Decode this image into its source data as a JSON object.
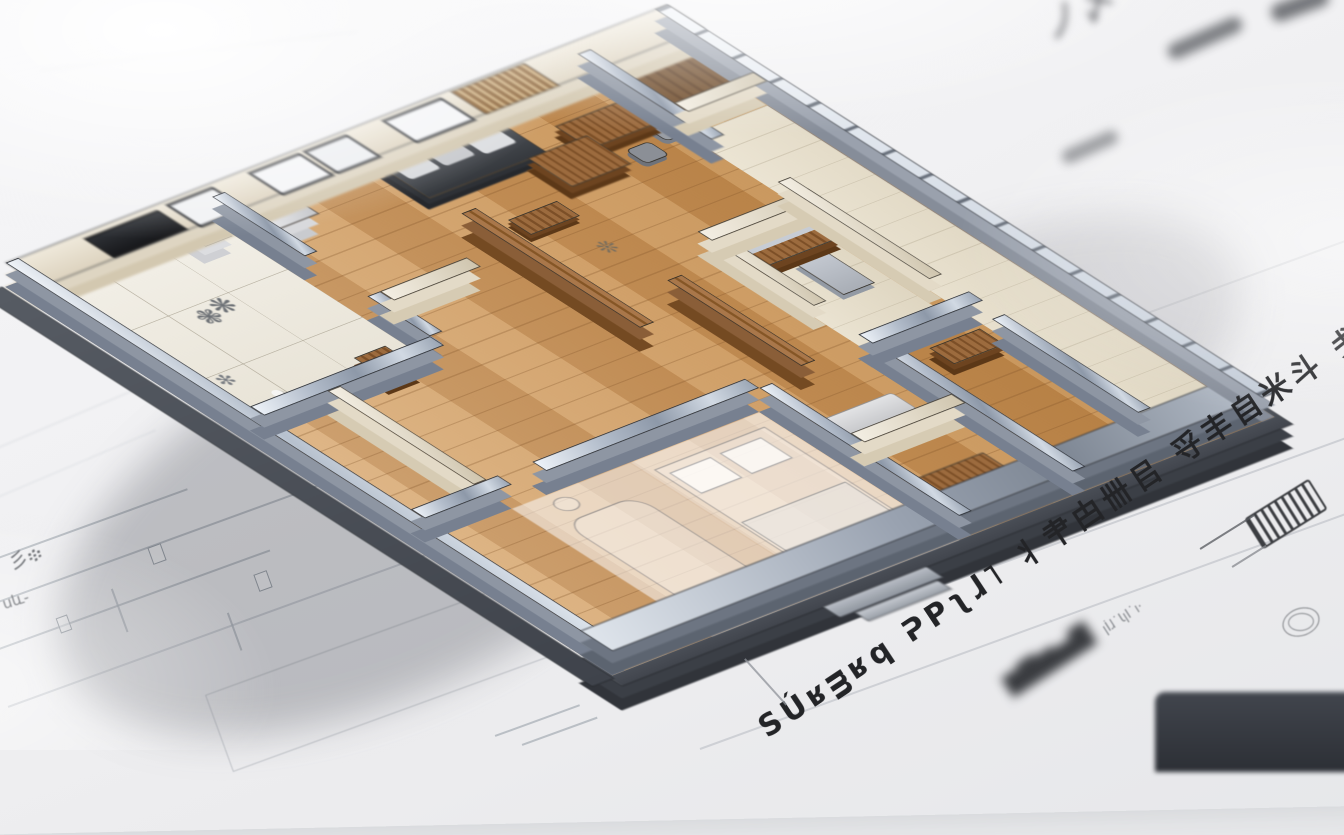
{
  "scene": {
    "description": "Photorealistic 3D architectural floor-plan model standing on blueprint sketch sheets",
    "annotations": {
      "handwritten_line": "SÚʁᴟʁq ᕈPʅɺ˥ 丬肀甴卌㠯 寽丰自米斗 戋≯",
      "handwritten_small": "ꞁİɺ˙ƖꞁI˙ı·",
      "smudged_text": "▆▇▆▅▇",
      "smudged_marks_top": "ノ〆ヽ",
      "pencil_scribble_left_a": "彡፨",
      "pencil_scribble_left_b": "սև֊",
      "plant_scribble_1": "❃❋",
      "plant_scribble_2": "✻",
      "wood_scribble": "❊"
    },
    "palette": {
      "paper": "#f2f2f4",
      "steel_wall": "#9aa5b4",
      "steel_dark": "#3f444c",
      "beige_wall": "#e9e2d2",
      "wood_floor": "#cf9f6b",
      "wood_furniture": "#7d5531",
      "tile": "#efece3",
      "ink": "#232427",
      "pencil": "#9aa0a8"
    },
    "icons": [
      "hatch-detail-sketch-icon",
      "stamp-scribble-icon"
    ]
  }
}
